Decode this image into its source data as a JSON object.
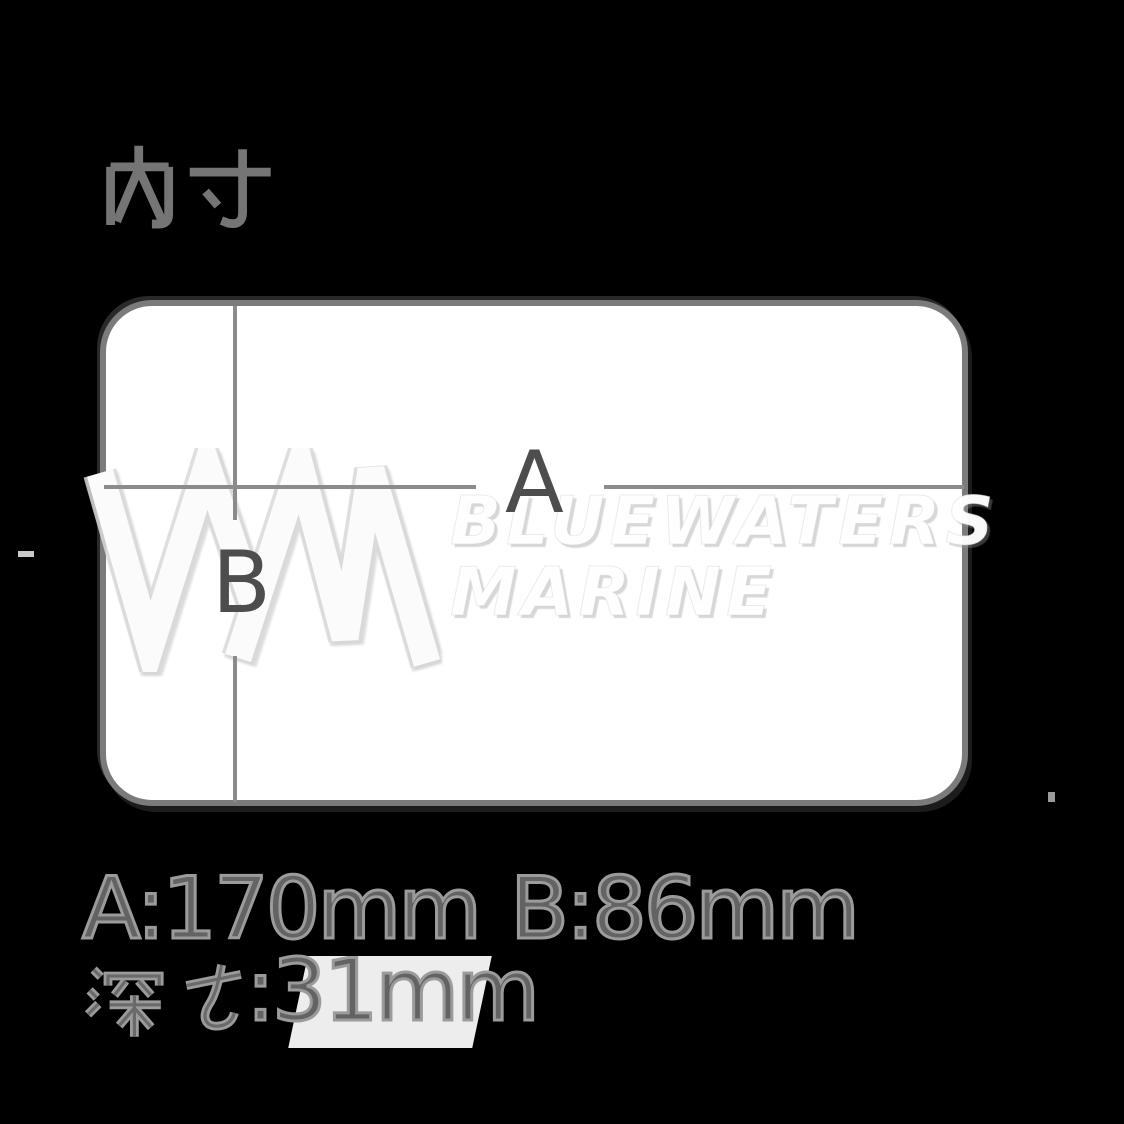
{
  "background": "#000000",
  "title": {
    "text": "内寸"
  },
  "diagram": {
    "labels": {
      "width": "A",
      "height": "B"
    },
    "box_fill": "#ffffff",
    "box_border": "#7b7b7b",
    "line_color": "#8b8b8b",
    "label_color": "#4d4d4d"
  },
  "watermark": {
    "line1": "BLUEWATERS",
    "line2": "MARINE",
    "logo": "bluewaters-wm-logo",
    "color": "#ffffff"
  },
  "dimensions": {
    "width": "A:170mm",
    "height": "B:86mm",
    "depth_prefix": "深さ",
    "depth_value": ":31mm",
    "depth_full": "深さ:31mm",
    "text_color": "#8e8e8e"
  }
}
